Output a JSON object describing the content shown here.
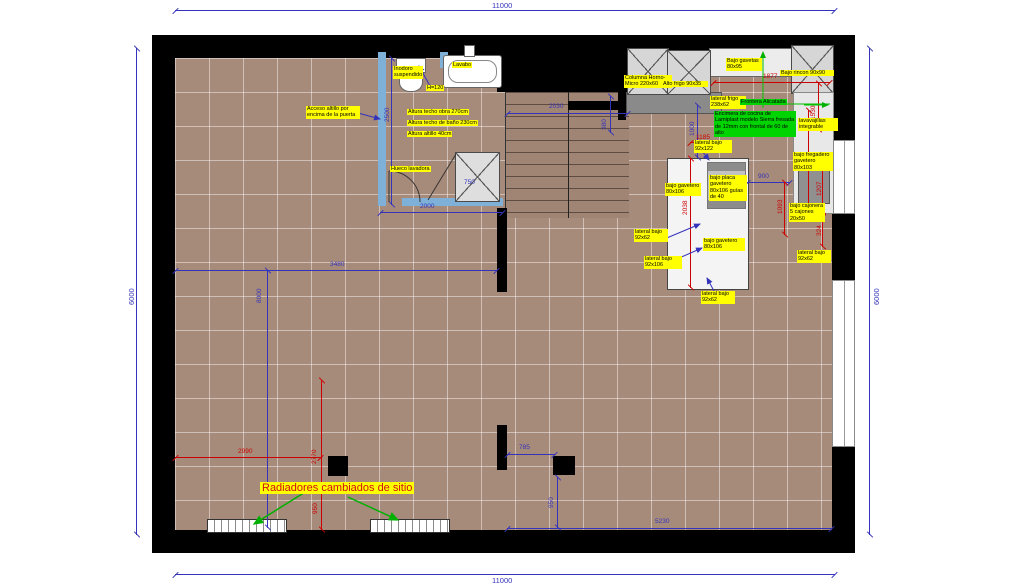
{
  "colors": {
    "dim_blue": "#3333bb",
    "dim_red": "#cc0000",
    "label_yellow": "#ffff00",
    "label_green": "#00d400",
    "wall_black": "#000000",
    "bath_wall_blue": "#7fb0d8",
    "floor_brown": "#a78b7a",
    "arrow_green": "#00b000"
  },
  "outer_dims": {
    "top": "11000",
    "bottom": "11000",
    "left": "6000",
    "right": "6000"
  },
  "bathroom": {
    "inodoro": "Inodoro suspendido",
    "lavabo": "Lavabo",
    "h120": "H=120",
    "acceso": "Acceso altillo por encima de la puerta",
    "altura_obra": "Altura techo obra 270cm",
    "altura_bano": "Altura techo de baño 230cm",
    "altura_altillo": "Altura altillo 40cm",
    "hueco_lavadora": "Hueco lavadora",
    "d2500": "2500",
    "d2000": "2000",
    "d750": "750"
  },
  "stairs": {
    "d2030": "2030",
    "d380": "380"
  },
  "kitchen": {
    "columna": "Columna Horno-Micro 220x60",
    "alto_frigo": "Alto frigo 90x35",
    "bajo_gavetas": "Bajo gavetas 80x95",
    "bajo_rincon": "Bajo rincon 90x90",
    "lateral_frigo": "lateral frigo 238x62",
    "frontera": "Frontera Alicatada",
    "encimera": "Encimera de cocina de Lamiplast modelo Sierra fresada de 12mm con frontal de 60 de alto",
    "lavavajillas": "lavavajillas integrable",
    "lateral_bajo_92x122": "lateral bajo 92x122",
    "bajo_fregadero": "bajo fregadero gavetero 80x103",
    "bajo_cajonera": "bajo cajonera 5 cajones 20x50",
    "lateral_bajo_92x62_right": "lateral bajo 92x62",
    "bajo_gavetero_left": "bajo gavetero 80x106",
    "bajo_placa": "bajo placa gavetero 80x106 guías de 40",
    "bajo_gavetero_lower": "bajo gavetero 80x106",
    "lateral_bajo_92x62_left": "lateral bajo 92x62",
    "lateral_bajo_92x106": "lateral bajo 92x106",
    "lateral_bajo_92x62_bottom": "lateral bajo 92x62",
    "d1000": "1000",
    "d900": "900",
    "r1877": "1877",
    "r1530": "1530",
    "r3043": "3043",
    "r1207": "1207",
    "r324": "324",
    "r1185": "1185",
    "r2038": "2038",
    "r1093": "1093"
  },
  "living": {
    "radiadores": "Radiadores cambiados de sitio",
    "d3480": "3480",
    "d8000": "8000",
    "d785": "785",
    "d950": "950",
    "d5230": "5230",
    "r2990": "2990",
    "r2770": "2770",
    "r950": "950"
  }
}
